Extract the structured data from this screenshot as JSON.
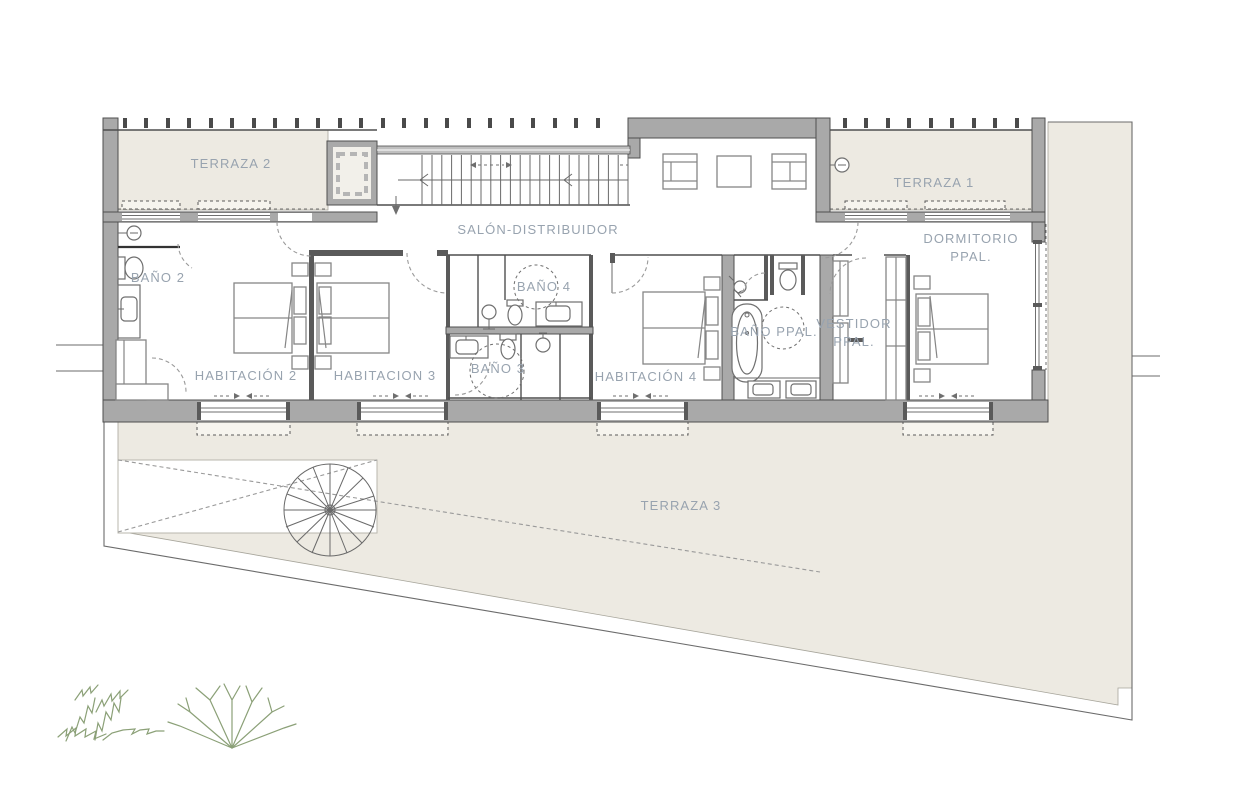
{
  "meta": {
    "kind": "architectural-floor-plan",
    "language": "es"
  },
  "palette": {
    "background": "#ffffff",
    "terrace_fill": "#edeae2",
    "wall_fill": "#a9a9a9",
    "wall_stroke": "#4f4f4f",
    "line": "#6a6a6a",
    "furniture_line": "#868686",
    "label_color": "#98a3af",
    "plant_color": "#8ba077"
  },
  "rooms": [
    {
      "id": "terraza-2",
      "label": "TERRAZA 2"
    },
    {
      "id": "terraza-1",
      "label": "TERRAZA 1"
    },
    {
      "id": "salon-distribuidor",
      "label": "SALÓN-DISTRIBUIDOR"
    },
    {
      "id": "bano-2",
      "label": "BAÑO 2"
    },
    {
      "id": "habitacion-2",
      "label": "HABITACIÓN 2"
    },
    {
      "id": "habitacion-3",
      "label": "HABITACION 3"
    },
    {
      "id": "bano-4",
      "label": "BAÑO 4"
    },
    {
      "id": "bano-3",
      "label": "BAÑO 3"
    },
    {
      "id": "habitacion-4",
      "label": "HABITACIÓN 4"
    },
    {
      "id": "bano-ppal",
      "label": "BAÑO PPAL."
    },
    {
      "id": "vestidor-ppal",
      "label": "VESTIDOR",
      "label2": "PPAL."
    },
    {
      "id": "dormitorio-ppal",
      "label": "DORMITORIO",
      "label2": "PPAL."
    },
    {
      "id": "terraza-3",
      "label": "TERRAZA 3"
    }
  ]
}
